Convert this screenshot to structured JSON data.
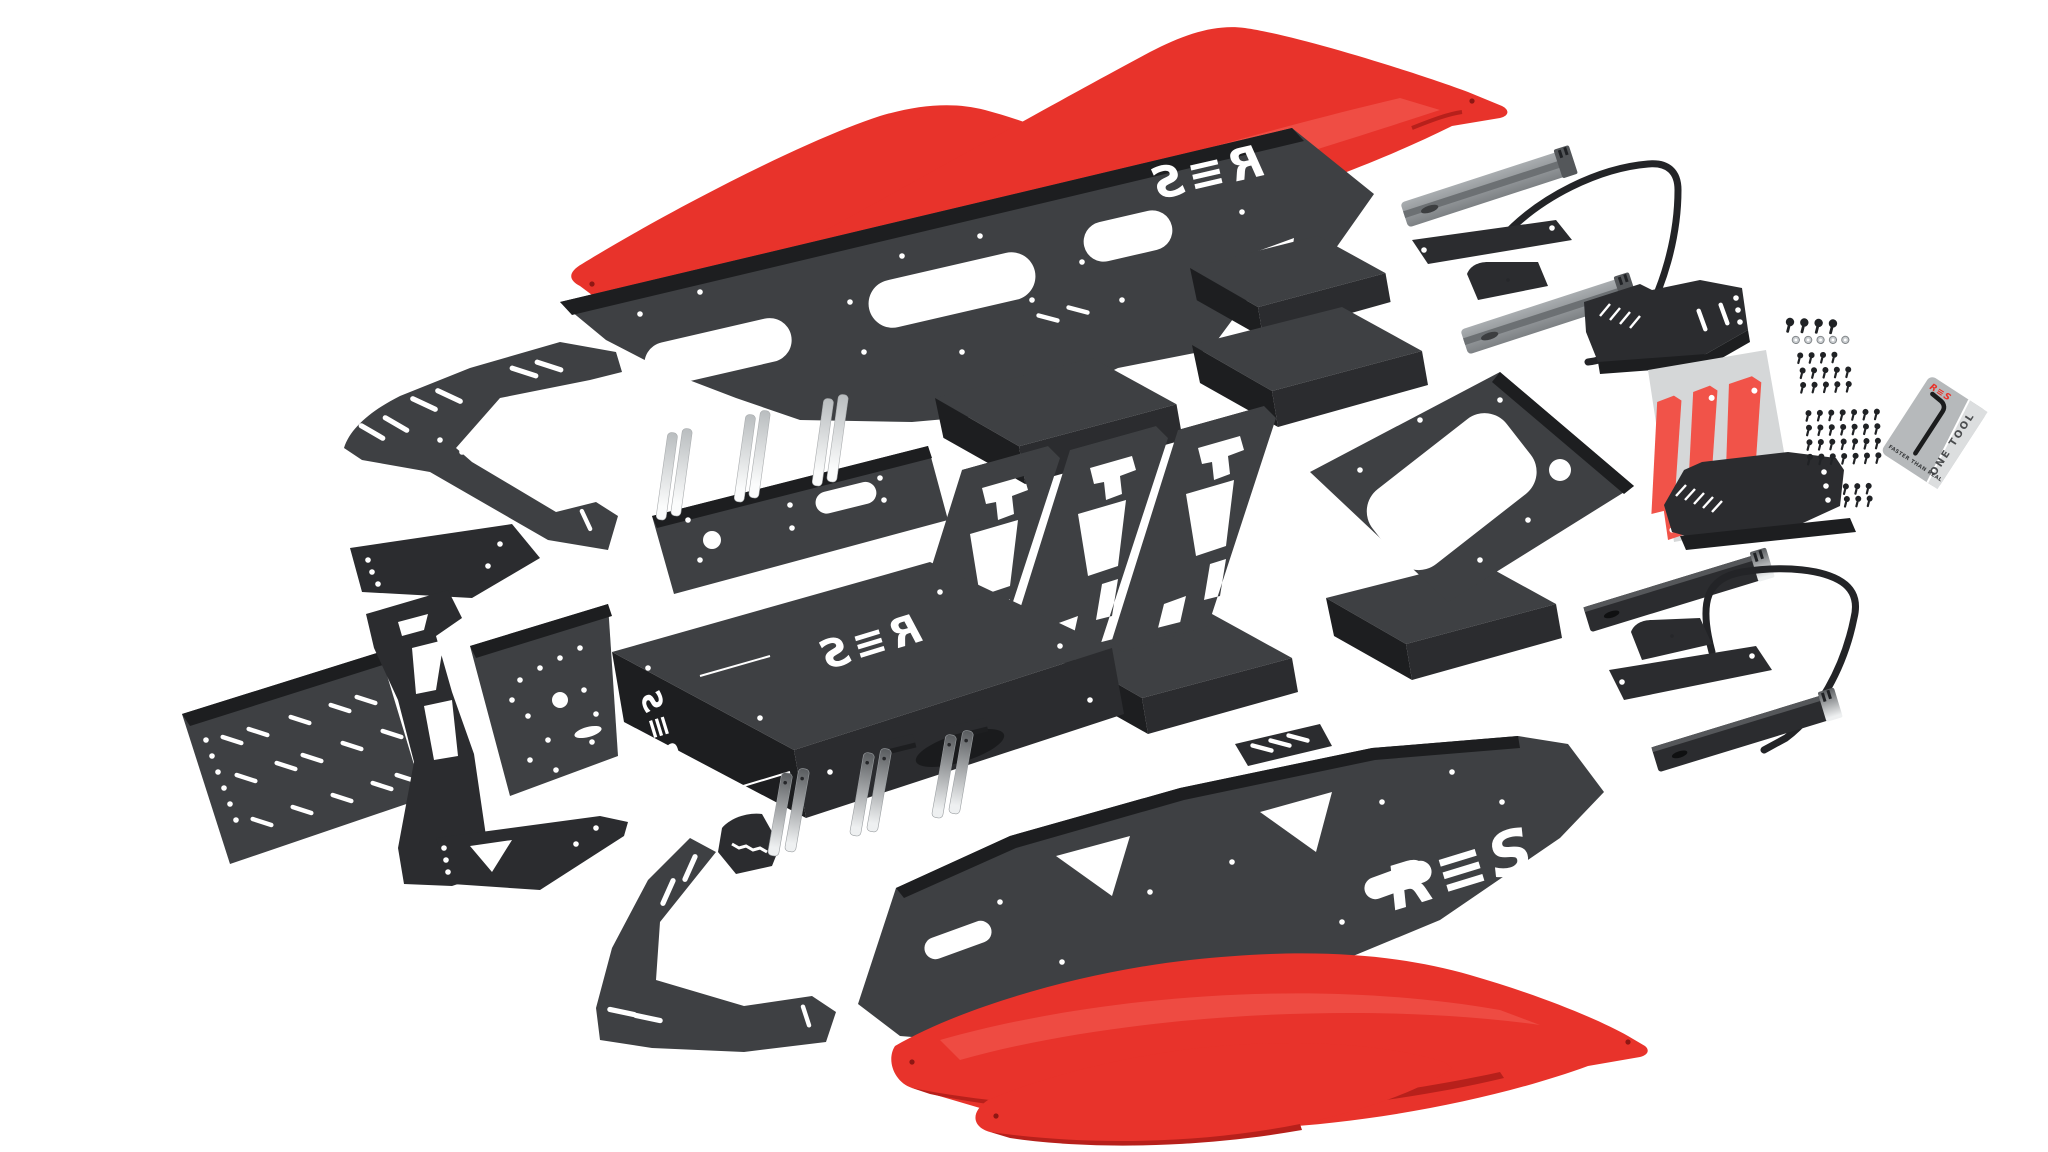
{
  "scene": {
    "background": "#ffffff",
    "kind": "exploded-parts-render"
  },
  "brand": {
    "name": "RES",
    "stylized": "R≡S"
  },
  "card": {
    "side_label": "ONE TOOL",
    "logo": "R≡S",
    "tagline": "FASTER THAN REAL"
  },
  "colors": {
    "white": "#ffffff",
    "accent_red": "#e8332b",
    "red_shadow": "#b7201b",
    "red_highlight": "#f4635a",
    "panel": "#3e4043",
    "panel_dark": "#2b2c2f",
    "panel_deep": "#1d1e20",
    "panel_light": "#55575a",
    "rail_gray": "#8f9396",
    "rail_light": "#c2c6c9",
    "silver_high": "#eef0f1",
    "silver_low": "#595c5f",
    "sheet_gray": "#d5d7d8",
    "decal_red": "#f15349",
    "card_gray": "#b6b9bb",
    "card_stripe": "#dcdedf",
    "ink_dark": "#3a3c3e",
    "tube_black": "#232427"
  },
  "parts": [
    {
      "name": "Side blade front upper"
    },
    {
      "name": "Side blade front lower"
    },
    {
      "name": "Main side panel left"
    },
    {
      "name": "Main side panel right"
    },
    {
      "name": "Seat slider rail x4"
    },
    {
      "name": "Seat frame tube x2"
    },
    {
      "name": "Seat side mount bracket x2"
    },
    {
      "name": "Seat base plate"
    },
    {
      "name": "Seat base cover"
    },
    {
      "name": "Floor plate"
    },
    {
      "name": "Support wedge channel x5"
    },
    {
      "name": "Truss brace plate x3"
    },
    {
      "name": "Pedal mounting plate"
    },
    {
      "name": "Pedal slider rail x3"
    },
    {
      "name": "Pedal box"
    },
    {
      "name": "Side arm plate upper"
    },
    {
      "name": "Side arm plate lower"
    },
    {
      "name": "Perforated base plate"
    },
    {
      "name": "Upright stand bracket"
    },
    {
      "name": "Accessory panel"
    },
    {
      "name": "Gusset bracket"
    },
    {
      "name": "Strap bracket"
    },
    {
      "name": "Galvanized angle bracket x3"
    },
    {
      "name": "Decal sheet with red decals"
    },
    {
      "name": "Hardware fastener set"
    },
    {
      "name": "Hex key tool card"
    }
  ]
}
